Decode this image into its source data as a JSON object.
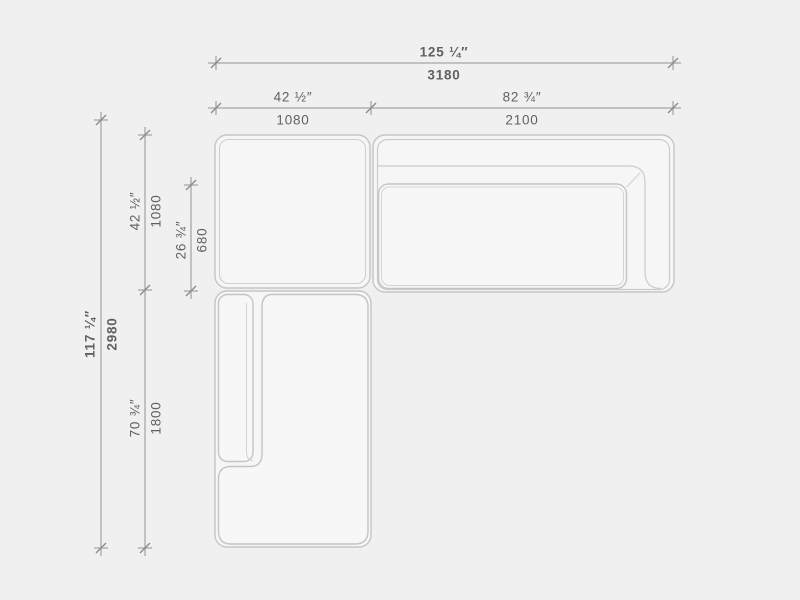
{
  "drawing": {
    "type": "sectional-sofa-plan",
    "background_color": "#f0f0f0",
    "outline_color": "#c6c6c6",
    "seam_color": "#cfcfcf",
    "dimension_line_color": "#929292",
    "text_color": "#616161"
  },
  "dimensions": {
    "total_width": {
      "inches": "125 ¼″",
      "mm": "3180"
    },
    "left_section_width": {
      "inches": "42 ½″",
      "mm": "1080"
    },
    "right_section_width": {
      "inches": "82 ¾″",
      "mm": "2100"
    },
    "total_depth": {
      "inches": "117 ¼″",
      "mm": "2980"
    },
    "corner_module_depth": {
      "inches": "42 ½″",
      "mm": "1080"
    },
    "seat_depth": {
      "inches": "26 ¾″",
      "mm": "680"
    },
    "chaise_depth": {
      "inches": "70 ¾″",
      "mm": "1800"
    }
  }
}
